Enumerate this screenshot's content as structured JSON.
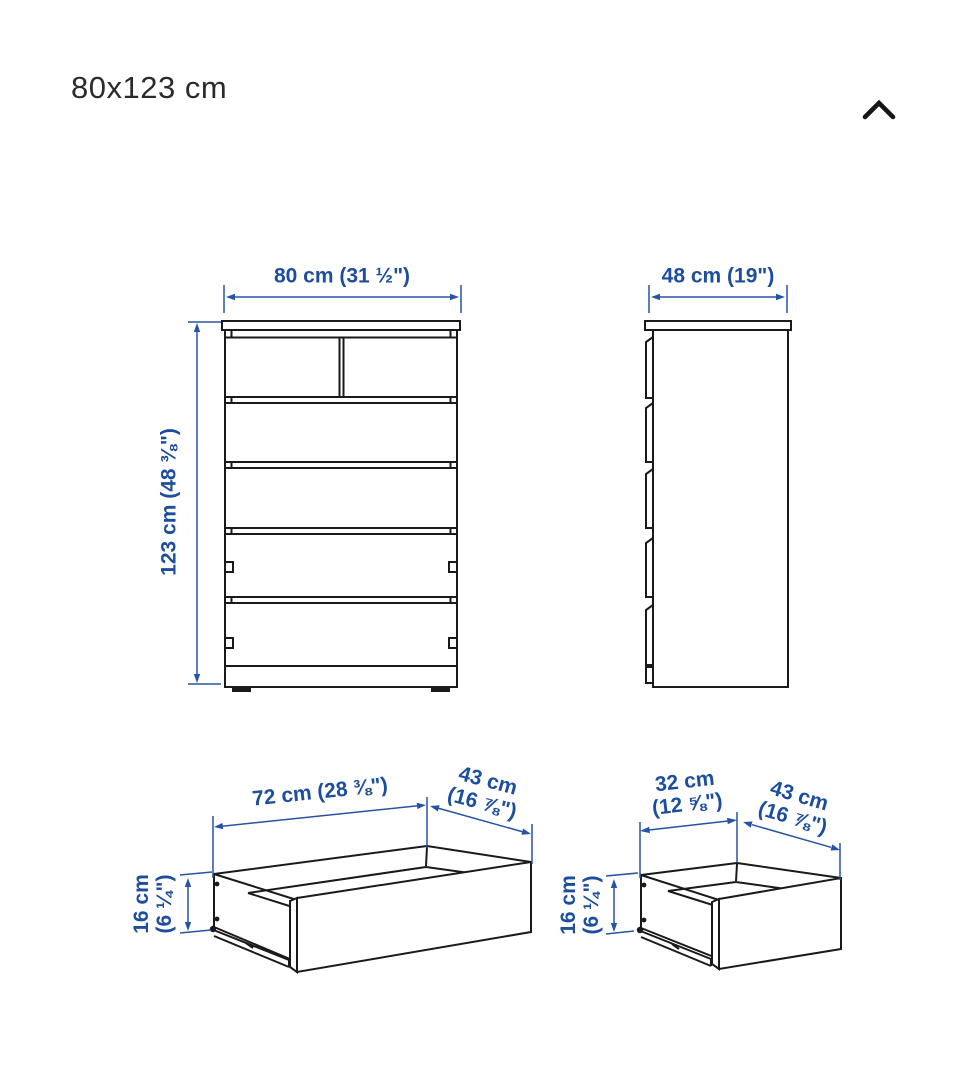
{
  "header": {
    "title": "80x123 cm"
  },
  "icons": {
    "collapse": "chevron-up"
  },
  "colors": {
    "dimension_blue": "#1d4e9e",
    "drawing_black": "#1a1a1a",
    "background": "#ffffff"
  },
  "dimensions": {
    "front_width": "80 cm (31 ½\")",
    "front_height": "123 cm (48 ⅜\")",
    "side_depth": "48 cm (19\")",
    "large_drawer": {
      "width": "72 cm (28 ⅜\")",
      "depth_line1": "43 cm",
      "depth_line2": "(16 ⅞\")",
      "height_line1": "16 cm",
      "height_line2": "(6 ¼\")"
    },
    "small_drawer": {
      "width_line1": "32 cm",
      "width_line2": "(12 ⅝\")",
      "depth_line1": "43 cm",
      "depth_line2": "(16 ⅞\")",
      "height_line1": "16 cm",
      "height_line2": "(6 ¼\")"
    }
  }
}
